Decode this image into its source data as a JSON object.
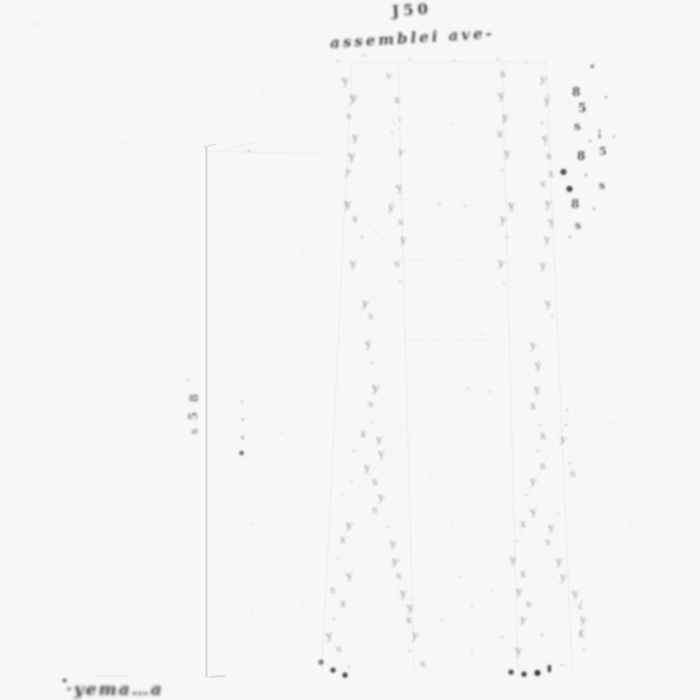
{
  "canvas": {
    "width": 700,
    "height": 700,
    "bg": "#fcfcfc",
    "ink": "#161616",
    "faint_line": "#8a8a8a"
  },
  "title": {
    "line1_approx": "J50",
    "line2_approx": "assemblei ave-"
  },
  "footer": {
    "scribble_approx": "·yema…a"
  },
  "linework": {
    "segments": [
      [
        206.5,
        147,
        206.5,
        677,
        0.5,
        1.3
      ],
      [
        203,
        147,
        216,
        144,
        0.3,
        1
      ],
      [
        208,
        151,
        320,
        154,
        0.1,
        1
      ],
      [
        222,
        150,
        258,
        142,
        0.14,
        1
      ],
      [
        209,
        677,
        226,
        676,
        0.4,
        1.2
      ],
      [
        96,
        676,
        128,
        676,
        0.15,
        1
      ],
      [
        352,
        62,
        546,
        62,
        0.08,
        1
      ],
      [
        398,
        130,
        502,
        130,
        0.05,
        1
      ],
      [
        398,
        200,
        502,
        200,
        0.05,
        1
      ],
      [
        398,
        260,
        502,
        260,
        0.05,
        1
      ],
      [
        398,
        340,
        502,
        340,
        0.05,
        1
      ],
      [
        398,
        430,
        502,
        430,
        0.05,
        1
      ],
      [
        398,
        520,
        502,
        520,
        0.05,
        1
      ],
      [
        398,
        600,
        502,
        600,
        0.05,
        1
      ]
    ],
    "legs": [
      [
        352,
        60,
        322,
        670,
        0.09,
        1
      ],
      [
        398,
        62,
        414,
        670,
        0.09,
        1
      ],
      [
        502,
        60,
        518,
        670,
        0.09,
        1
      ],
      [
        546,
        60,
        572,
        670,
        0.09,
        1
      ]
    ],
    "pairs": [
      {
        "a": [
          352,
          60,
          322,
          670
        ],
        "b": [
          398,
          62,
          414,
          670
        ]
      },
      {
        "a": [
          502,
          60,
          518,
          670
        ],
        "b": [
          546,
          60,
          572,
          670
        ]
      }
    ],
    "panel_ys": [
      62,
      130,
      200,
      260,
      340,
      430,
      520,
      600,
      668
    ],
    "zigzag_opacity": 0.05
  },
  "marks": [
    [
      30,
      18,
      "‥",
      0.12,
      10,
      0
    ],
    [
      336,
      56,
      "·",
      0.25,
      11,
      0
    ],
    [
      360,
      52,
      "~",
      0.2,
      10,
      0
    ],
    [
      408,
      54,
      "·",
      0.2,
      11,
      0
    ],
    [
      452,
      56,
      "-",
      0.18,
      10,
      0
    ],
    [
      496,
      54,
      "·",
      0.22,
      11,
      0
    ],
    [
      524,
      58,
      "·",
      0.2,
      11,
      0
    ],
    [
      342,
      75,
      "y",
      0.32,
      11,
      -8
    ],
    [
      386,
      72,
      "v",
      0.26,
      10,
      5
    ],
    [
      500,
      70,
      "s",
      0.3,
      10,
      0
    ],
    [
      540,
      74,
      "y",
      0.3,
      11,
      10
    ],
    [
      590,
      62,
      "▪",
      0.5,
      7,
      0
    ],
    [
      350,
      92,
      "y",
      0.36,
      12,
      6
    ],
    [
      394,
      96,
      "x",
      0.3,
      10,
      0
    ],
    [
      498,
      90,
      "y",
      0.34,
      11,
      -6
    ],
    [
      544,
      95,
      "ý",
      0.32,
      11,
      0
    ],
    [
      346,
      112,
      "s",
      0.28,
      10,
      0
    ],
    [
      398,
      115,
      "·",
      0.3,
      11,
      0
    ],
    [
      502,
      112,
      "y",
      0.35,
      11,
      8
    ],
    [
      540,
      118,
      "·",
      0.3,
      11,
      0
    ],
    [
      352,
      132,
      "y",
      0.34,
      11,
      0
    ],
    [
      390,
      128,
      "·",
      0.26,
      11,
      0
    ],
    [
      497,
      130,
      "x",
      0.3,
      10,
      0
    ],
    [
      542,
      133,
      "y",
      0.33,
      11,
      -10
    ],
    [
      348,
      150,
      "y",
      0.35,
      12,
      -5
    ],
    [
      398,
      148,
      "y",
      0.3,
      10,
      12
    ],
    [
      504,
      148,
      "y",
      0.34,
      11,
      0
    ],
    [
      546,
      152,
      "s",
      0.3,
      10,
      0
    ],
    [
      247,
      146,
      "·",
      0.35,
      11,
      0
    ],
    [
      345,
      168,
      "y",
      0.3,
      10,
      15
    ],
    [
      500,
      165,
      "·",
      0.28,
      11,
      0
    ],
    [
      548,
      170,
      "x",
      0.28,
      10,
      0
    ],
    [
      396,
      182,
      "y",
      0.33,
      11,
      -12
    ],
    [
      540,
      180,
      "x",
      0.3,
      10,
      0
    ],
    [
      344,
      198,
      "y",
      0.36,
      12,
      0
    ],
    [
      388,
      202,
      "ý",
      0.32,
      11,
      8
    ],
    [
      437,
      200,
      "-",
      0.25,
      10,
      0
    ],
    [
      463,
      202,
      "-",
      0.22,
      10,
      0
    ],
    [
      508,
      200,
      "y",
      0.35,
      11,
      -8
    ],
    [
      545,
      198,
      "y",
      0.32,
      11,
      0
    ],
    [
      352,
      215,
      "x",
      0.3,
      10,
      0
    ],
    [
      398,
      218,
      "s",
      0.28,
      10,
      0
    ],
    [
      500,
      214,
      "y",
      0.33,
      11,
      6
    ],
    [
      548,
      216,
      "y",
      0.3,
      11,
      -14
    ],
    [
      360,
      232,
      "·",
      0.3,
      11,
      0
    ],
    [
      400,
      234,
      "y",
      0.32,
      11,
      0
    ],
    [
      505,
      232,
      "·",
      0.28,
      11,
      0
    ],
    [
      544,
      234,
      "y",
      0.3,
      11,
      0
    ],
    [
      350,
      258,
      "y",
      0.33,
      11,
      -6
    ],
    [
      394,
      260,
      "s",
      0.28,
      10,
      0
    ],
    [
      498,
      258,
      "y",
      0.32,
      11,
      10
    ],
    [
      540,
      260,
      "y",
      0.3,
      11,
      0
    ],
    [
      398,
      276,
      "·",
      0.25,
      11,
      0
    ],
    [
      502,
      278,
      "·",
      0.25,
      11,
      0
    ],
    [
      362,
      298,
      "y",
      0.33,
      11,
      8
    ],
    [
      545,
      298,
      "y",
      0.32,
      11,
      -8
    ],
    [
      368,
      312,
      "s",
      0.26,
      10,
      0
    ],
    [
      550,
      312,
      "·",
      0.24,
      11,
      0
    ],
    [
      365,
      338,
      "y",
      0.32,
      11,
      -10
    ],
    [
      530,
      340,
      "y",
      0.3,
      11,
      6
    ],
    [
      370,
      358,
      "·",
      0.24,
      11,
      0
    ],
    [
      535,
      360,
      "ý",
      0.3,
      11,
      0
    ],
    [
      372,
      382,
      "y",
      0.33,
      12,
      6
    ],
    [
      466,
      384,
      "·",
      0.2,
      11,
      0
    ],
    [
      488,
      387,
      "·",
      0.2,
      11,
      0
    ],
    [
      534,
      384,
      "y",
      0.32,
      11,
      -6
    ],
    [
      368,
      400,
      "s",
      0.28,
      10,
      0
    ],
    [
      530,
      402,
      "x",
      0.3,
      10,
      0
    ],
    [
      370,
      418,
      "·",
      0.24,
      11,
      0
    ],
    [
      538,
      420,
      "·",
      0.26,
      11,
      0
    ],
    [
      564,
      420,
      "·",
      0.3,
      11,
      0
    ],
    [
      360,
      430,
      "x",
      0.3,
      10,
      10
    ],
    [
      376,
      434,
      "y",
      0.32,
      11,
      0
    ],
    [
      540,
      432,
      "x",
      0.3,
      10,
      0
    ],
    [
      560,
      434,
      "y",
      0.3,
      11,
      12
    ],
    [
      352,
      446,
      "·",
      0.24,
      11,
      0
    ],
    [
      378,
      448,
      "y",
      0.3,
      11,
      -8
    ],
    [
      536,
      446,
      "·",
      0.24,
      11,
      0
    ],
    [
      568,
      458,
      "·",
      0.28,
      11,
      0
    ],
    [
      364,
      462,
      "y",
      0.32,
      11,
      0
    ],
    [
      540,
      462,
      "s",
      0.28,
      10,
      0
    ],
    [
      570,
      470,
      "s",
      0.26,
      10,
      0
    ],
    [
      350,
      476,
      "·",
      0.22,
      11,
      0
    ],
    [
      372,
      478,
      "x",
      0.3,
      10,
      -10
    ],
    [
      530,
      476,
      "y",
      0.3,
      11,
      8
    ],
    [
      340,
      490,
      "·",
      0.22,
      11,
      0
    ],
    [
      378,
      492,
      "y",
      0.32,
      11,
      6
    ],
    [
      524,
      490,
      "·",
      0.24,
      11,
      0
    ],
    [
      372,
      506,
      "s",
      0.28,
      10,
      0
    ],
    [
      530,
      506,
      "y",
      0.32,
      11,
      -10
    ],
    [
      556,
      508,
      "·",
      0.24,
      11,
      0
    ],
    [
      346,
      520,
      "y",
      0.33,
      11,
      8
    ],
    [
      386,
      522,
      "·",
      0.24,
      11,
      0
    ],
    [
      520,
      520,
      "x",
      0.3,
      10,
      0
    ],
    [
      548,
      522,
      "y",
      0.3,
      11,
      0
    ],
    [
      340,
      536,
      "x",
      0.3,
      10,
      0
    ],
    [
      390,
      538,
      "y",
      0.32,
      11,
      -6
    ],
    [
      515,
      536,
      "·",
      0.22,
      11,
      0
    ],
    [
      545,
      538,
      "s",
      0.26,
      10,
      0
    ],
    [
      336,
      554,
      "·",
      0.24,
      11,
      0
    ],
    [
      392,
      556,
      "y",
      0.33,
      11,
      10
    ],
    [
      510,
      554,
      "y",
      0.32,
      11,
      -8
    ],
    [
      556,
      556,
      "y",
      0.3,
      11,
      0
    ],
    [
      346,
      570,
      "y",
      0.33,
      11,
      -12
    ],
    [
      396,
      572,
      "s",
      0.28,
      10,
      0
    ],
    [
      458,
      572,
      "·",
      0.2,
      11,
      0
    ],
    [
      520,
      570,
      "x",
      0.3,
      10,
      0
    ],
    [
      560,
      572,
      "y",
      0.3,
      11,
      8
    ],
    [
      330,
      586,
      "s",
      0.28,
      10,
      0
    ],
    [
      400,
      588,
      "y",
      0.33,
      11,
      0
    ],
    [
      490,
      586,
      "·",
      0.22,
      11,
      0
    ],
    [
      516,
      586,
      "y",
      0.32,
      11,
      6
    ],
    [
      572,
      588,
      "y",
      0.3,
      11,
      -10
    ],
    [
      340,
      600,
      "x",
      0.3,
      10,
      8
    ],
    [
      407,
      602,
      "y",
      0.33,
      11,
      -6
    ],
    [
      470,
      601,
      "·",
      0.2,
      11,
      0
    ],
    [
      526,
      600,
      "s",
      0.28,
      10,
      0
    ],
    [
      578,
      600,
      "¿",
      0.3,
      10,
      0
    ],
    [
      332,
      614,
      "·",
      0.24,
      11,
      0
    ],
    [
      406,
      616,
      "x",
      0.3,
      10,
      0
    ],
    [
      440,
      616,
      "-",
      0.2,
      10,
      0
    ],
    [
      520,
      614,
      "y",
      0.32,
      11,
      10
    ],
    [
      580,
      614,
      "y",
      0.3,
      11,
      0
    ],
    [
      326,
      630,
      "y",
      0.33,
      11,
      -8
    ],
    [
      412,
      630,
      "y",
      0.32,
      11,
      8
    ],
    [
      500,
      632,
      "·",
      0.22,
      11,
      0
    ],
    [
      540,
      630,
      "·",
      0.24,
      11,
      0
    ],
    [
      578,
      630,
      "£",
      0.34,
      10,
      0
    ],
    [
      336,
      645,
      "s",
      0.28,
      10,
      0
    ],
    [
      408,
      646,
      "·",
      0.24,
      11,
      0
    ],
    [
      470,
      648,
      "·",
      0.2,
      11,
      0
    ],
    [
      515,
      645,
      "y",
      0.32,
      11,
      -6
    ],
    [
      582,
      645,
      "·",
      0.26,
      11,
      0
    ],
    [
      318,
      658,
      "●",
      0.6,
      7,
      0
    ],
    [
      347,
      662,
      "·",
      0.3,
      11,
      0
    ],
    [
      420,
      660,
      "s",
      0.26,
      10,
      0
    ],
    [
      560,
      660,
      "·",
      0.3,
      11,
      0
    ],
    [
      330,
      666,
      "●",
      0.8,
      7,
      0
    ],
    [
      342,
      671,
      "●",
      0.85,
      7,
      0
    ],
    [
      508,
      668,
      "●",
      0.8,
      7,
      0
    ],
    [
      521,
      670,
      "●",
      0.85,
      7,
      0
    ],
    [
      534,
      668,
      "●",
      0.9,
      8,
      0
    ],
    [
      547,
      665,
      "▮",
      0.85,
      9,
      0
    ],
    [
      572,
      86,
      "8",
      0.75,
      12,
      0
    ],
    [
      578,
      102,
      "5",
      0.8,
      12,
      0
    ],
    [
      574,
      120,
      "s",
      0.7,
      12,
      0
    ],
    [
      588,
      136,
      "·",
      0.6,
      11,
      0
    ],
    [
      577,
      150,
      "8",
      0.8,
      12,
      0
    ],
    [
      597,
      127,
      "¡",
      0.7,
      11,
      0
    ],
    [
      599,
      146,
      "5",
      0.75,
      11,
      0
    ],
    [
      604,
      93,
      "-",
      0.5,
      10,
      0
    ],
    [
      612,
      133,
      "·",
      0.45,
      10,
      0
    ],
    [
      560,
      167,
      "●",
      0.8,
      8,
      0
    ],
    [
      584,
      170,
      "·",
      0.55,
      11,
      0
    ],
    [
      566,
      184,
      "●",
      0.85,
      8,
      0
    ],
    [
      599,
      180,
      "s",
      0.7,
      11,
      0
    ],
    [
      571,
      198,
      "8",
      0.7,
      12,
      0
    ],
    [
      592,
      204,
      "·",
      0.5,
      11,
      0
    ],
    [
      575,
      220,
      "s",
      0.65,
      11,
      0
    ],
    [
      568,
      232,
      "·",
      0.5,
      11,
      0
    ],
    [
      565,
      405,
      "·",
      0.3,
      11,
      0
    ],
    [
      188,
      375,
      "·",
      0.45,
      10,
      -90
    ],
    [
      190,
      392,
      "8",
      0.55,
      12,
      -90
    ],
    [
      189,
      410,
      "5",
      0.55,
      12,
      -90
    ],
    [
      191,
      426,
      "s",
      0.45,
      11,
      -90
    ],
    [
      240,
      398,
      "·",
      0.5,
      10,
      0
    ],
    [
      241,
      416,
      "·",
      0.55,
      10,
      0
    ],
    [
      240,
      432,
      "-",
      0.6,
      11,
      -90
    ],
    [
      239,
      448,
      "▪",
      0.7,
      8,
      0
    ],
    [
      62,
      678,
      "●",
      0.55,
      6,
      0
    ],
    [
      120,
      140,
      "·",
      0.14,
      10,
      0
    ],
    [
      260,
      90,
      "·",
      0.13,
      10,
      0
    ],
    [
      300,
      250,
      "·",
      0.13,
      10,
      0
    ],
    [
      160,
      300,
      "·",
      0.12,
      10,
      0
    ],
    [
      250,
      520,
      "·",
      0.13,
      10,
      0
    ],
    [
      280,
      430,
      "·",
      0.12,
      10,
      0
    ],
    [
      300,
      600,
      "·",
      0.13,
      10,
      0
    ],
    [
      450,
      120,
      "·",
      0.14,
      10,
      0
    ],
    [
      430,
      260,
      "·",
      0.12,
      10,
      0
    ],
    [
      480,
      330,
      "·",
      0.13,
      10,
      0
    ],
    [
      300,
      330,
      "·",
      0.12,
      10,
      0
    ],
    [
      240,
      260,
      "·",
      0.12,
      10,
      0
    ],
    [
      430,
      470,
      "·",
      0.13,
      10,
      0
    ],
    [
      450,
      520,
      "·",
      0.12,
      10,
      0
    ],
    [
      620,
      320,
      "·",
      0.12,
      10,
      0
    ],
    [
      630,
      520,
      "·",
      0.12,
      10,
      0
    ],
    [
      610,
      420,
      "·",
      0.12,
      10,
      0
    ],
    [
      250,
      610,
      "·",
      0.13,
      10,
      0
    ],
    [
      150,
      560,
      "·",
      0.12,
      10,
      0
    ],
    [
      100,
      420,
      "·",
      0.12,
      10,
      0
    ]
  ]
}
